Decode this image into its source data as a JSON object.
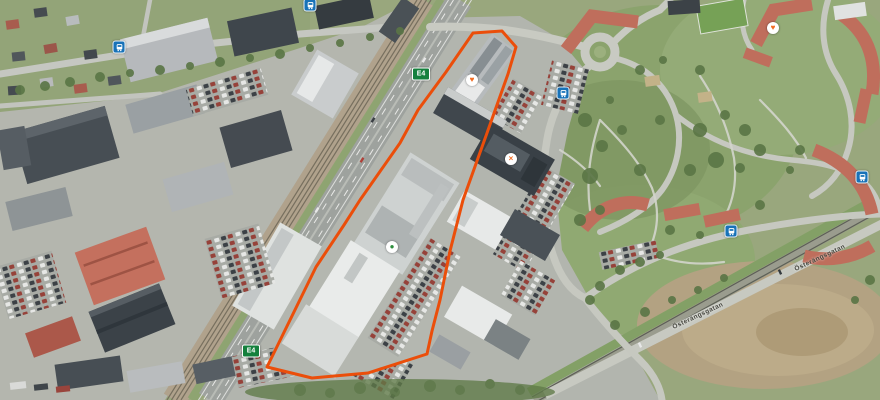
{
  "map": {
    "description": "Aerial satellite view of industrial and residential area with highlighted property boundary along the E4 motorway",
    "boundary": {
      "color": "#eb4e0a",
      "stroke_width": 3,
      "points": "473,33 502,31 516,47 508,74 487,133 463,200 450,251 440,300 432,331 427,354 368,373 312,378 267,367 316,267 344,225 360,200 400,143 418,110 446,72"
    },
    "route_shields": [
      {
        "label": "E4",
        "x": 421,
        "y": 74,
        "bg": "#15803d",
        "fg": "#ffffff"
      },
      {
        "label": "E4",
        "x": 251,
        "y": 351,
        "bg": "#15803d",
        "fg": "#ffffff"
      }
    ],
    "bus_stop_color": "#1872b8",
    "bus_stops": [
      {
        "x": 310,
        "y": 5
      },
      {
        "x": 119,
        "y": 47
      },
      {
        "x": 563,
        "y": 93
      },
      {
        "x": 862,
        "y": 177
      },
      {
        "x": 731,
        "y": 231
      }
    ],
    "poi_markers": [
      {
        "x": 472,
        "y": 80,
        "glyph": "♥",
        "color": "#f26a1f",
        "name": "heart-poi-marker"
      },
      {
        "x": 773,
        "y": 28,
        "glyph": "♥",
        "color": "#f26a1f",
        "name": "heart-poi-marker"
      },
      {
        "x": 511,
        "y": 159,
        "glyph": "×",
        "color": "#f26a1f",
        "name": "cross-poi-marker"
      },
      {
        "x": 392,
        "y": 247,
        "glyph": "●",
        "color": "#2f8f3e",
        "name": "green-poi-marker"
      }
    ],
    "street_labels": [
      {
        "text": "Österängsgatan",
        "x": 820,
        "y": 258,
        "rotation": -25
      },
      {
        "text": "Österängsgatan",
        "x": 698,
        "y": 316,
        "rotation": -25
      }
    ]
  }
}
